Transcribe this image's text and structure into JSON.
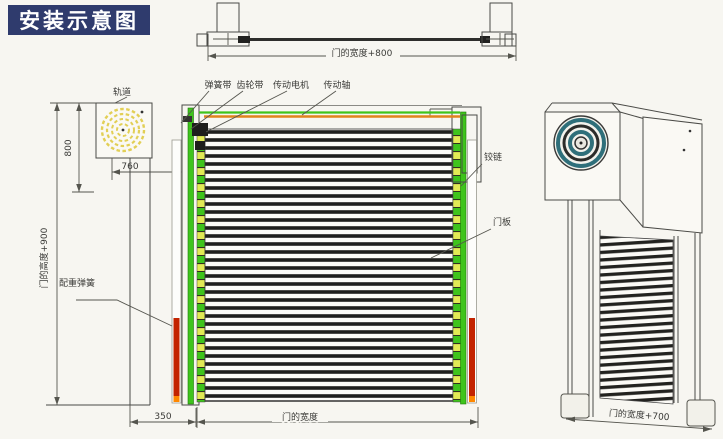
{
  "title": "安装示意图",
  "colors": {
    "banner_bg": "#2f3b6d",
    "banner_text": "#ffffff",
    "paper": "#f7f6f1",
    "line": "#4a4a46",
    "green": "#3fc41c",
    "yellow_green": "#e2ea55",
    "orange": "#e0831c",
    "red": "#c32300",
    "red_tip": "#ff8800",
    "spiral_yellow": "#e2cf55",
    "coil_teal": "#2f6f7a"
  },
  "top_view": {
    "dim_width": "门的宽度+800"
  },
  "side_view": {
    "track_label": "轨道",
    "dim_height": "800",
    "dim_width": "760",
    "dim_total_height": "门的高度+900",
    "dim_offset": "350"
  },
  "front_view": {
    "label_spring_belt": "弹簧带",
    "label_gear_belt": "齿轮带",
    "label_drive_motor": "传动电机",
    "label_drive_shaft": "传动轴",
    "label_hinge": "铰链",
    "label_door_panel": "门板",
    "label_counterweight_spring": "配重弹簧",
    "dim_width": "门的宽度"
  },
  "perspective_view": {
    "dim_width": "门的宽度+700"
  }
}
